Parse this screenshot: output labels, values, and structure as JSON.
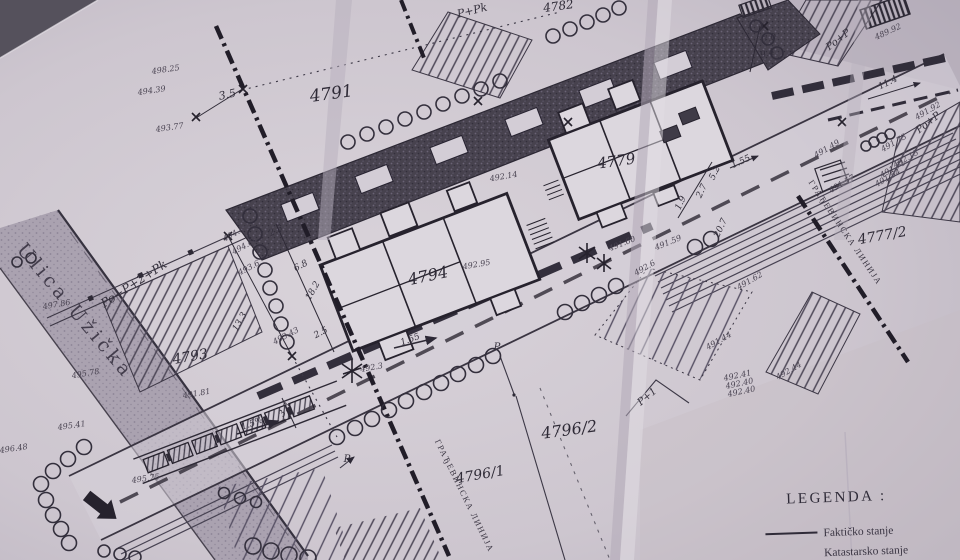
{
  "document": {
    "kind": "scanned cadastral site plan (photographed paper drawing)"
  },
  "street": {
    "name": "Ulica Užička",
    "x": 16,
    "y": 250,
    "r": 50,
    "s": 19
  },
  "labels": {
    "parcels": [
      {
        "t": "4791",
        "x": 332,
        "y": 99,
        "r": -8,
        "s": 17
      },
      {
        "t": "4782",
        "x": 559,
        "y": 10,
        "r": -8,
        "s": 12
      },
      {
        "t": "4779",
        "x": 617,
        "y": 166,
        "r": -8,
        "s": 15
      },
      {
        "t": "4794",
        "x": 429,
        "y": 281,
        "r": -12,
        "s": 16
      },
      {
        "t": "4793",
        "x": 191,
        "y": 361,
        "r": -10,
        "s": 14
      },
      {
        "t": "4796/2",
        "x": 570,
        "y": 435,
        "r": -8,
        "s": 16
      },
      {
        "t": "4796/1",
        "x": 481,
        "y": 479,
        "r": -10,
        "s": 14
      },
      {
        "t": "4777/2",
        "x": 883,
        "y": 240,
        "r": -10,
        "s": 14
      }
    ],
    "buildings": [
      {
        "t": "P+Pk",
        "x": 473,
        "y": 14,
        "r": -14,
        "s": 11
      },
      {
        "t": "Po+P",
        "x": 840,
        "y": 42,
        "r": -38,
        "s": 10
      },
      {
        "t": "Po+P",
        "x": 930,
        "y": 125,
        "r": -38,
        "s": 10
      },
      {
        "t": "Po+P+2+Pk",
        "x": 136,
        "y": 287,
        "r": -33,
        "s": 12
      },
      {
        "t": "P+1",
        "x": 649,
        "y": 399,
        "r": -40,
        "s": 10
      },
      {
        "t": "P",
        "x": 497,
        "y": 350,
        "r": 0,
        "s": 10
      },
      {
        "t": "P",
        "x": 347,
        "y": 462,
        "r": 0,
        "s": 10
      }
    ],
    "lines": [
      {
        "t": "ГРАЂЕВИНСКА ЛИНИЈА",
        "x": 843,
        "y": 234,
        "r": 56,
        "s": 8.5
      },
      {
        "t": "ГРАЂЕВИНСКА ЛИНИЈА",
        "x": 462,
        "y": 497,
        "r": 64,
        "s": 8.5
      }
    ],
    "elevations": [
      {
        "t": "498.25",
        "x": 166,
        "y": 72,
        "r": -8
      },
      {
        "t": "494.39",
        "x": 152,
        "y": 93,
        "r": -8
      },
      {
        "t": "493.77",
        "x": 170,
        "y": 130,
        "r": -8
      },
      {
        "t": "497.86",
        "x": 57,
        "y": 307,
        "r": -10
      },
      {
        "t": "495.78",
        "x": 86,
        "y": 376,
        "r": -10
      },
      {
        "t": "491.81",
        "x": 197,
        "y": 396,
        "r": -10
      },
      {
        "t": "495.41",
        "x": 72,
        "y": 428,
        "r": -8
      },
      {
        "t": "496.48",
        "x": 14,
        "y": 451,
        "r": -8
      },
      {
        "t": "495.75",
        "x": 146,
        "y": 481,
        "r": -8
      },
      {
        "t": "494.65",
        "x": 237,
        "y": 235,
        "r": -28
      },
      {
        "t": "494.64",
        "x": 246,
        "y": 248,
        "r": -28
      },
      {
        "t": "493.6",
        "x": 250,
        "y": 270,
        "r": -28
      },
      {
        "t": "493.43",
        "x": 287,
        "y": 338,
        "r": -28
      },
      {
        "t": "492.95",
        "x": 477,
        "y": 267,
        "r": -10
      },
      {
        "t": "492.14",
        "x": 504,
        "y": 179,
        "r": -10
      },
      {
        "t": "491.60",
        "x": 623,
        "y": 246,
        "r": -22
      },
      {
        "t": "491.59",
        "x": 669,
        "y": 245,
        "r": -22
      },
      {
        "t": "492.6",
        "x": 646,
        "y": 270,
        "r": -30
      },
      {
        "t": "491.44",
        "x": 720,
        "y": 343,
        "r": -30
      },
      {
        "t": "492.44",
        "x": 790,
        "y": 373,
        "r": -30
      },
      {
        "t": "492.41",
        "x": 738,
        "y": 378,
        "r": -12
      },
      {
        "t": "492.40",
        "x": 740,
        "y": 386,
        "r": -12
      },
      {
        "t": "492.40",
        "x": 742,
        "y": 394,
        "r": -12
      },
      {
        "t": "489.92",
        "x": 889,
        "y": 34,
        "r": -25
      },
      {
        "t": "491.92",
        "x": 929,
        "y": 113,
        "r": -30
      },
      {
        "t": "491.49",
        "x": 828,
        "y": 151,
        "r": -30
      },
      {
        "t": "491.73",
        "x": 895,
        "y": 145,
        "r": -30
      },
      {
        "t": "492.15",
        "x": 907,
        "y": 161,
        "r": -30
      },
      {
        "t": "491.71",
        "x": 894,
        "y": 171,
        "r": -30
      },
      {
        "t": "491.54",
        "x": 889,
        "y": 180,
        "r": -30
      },
      {
        "t": "491.57",
        "x": 843,
        "y": 186,
        "r": -30
      },
      {
        "t": "492.3",
        "x": 372,
        "y": 370,
        "r": -10
      },
      {
        "t": "491.62",
        "x": 751,
        "y": 283,
        "r": -30
      }
    ],
    "dimensions": [
      {
        "t": "3.5",
        "x": 228,
        "y": 98,
        "r": -12,
        "s": 11
      },
      {
        "t": "7.0",
        "x": 770,
        "y": 41,
        "r": -15
      },
      {
        "t": "9.4",
        "x": 768,
        "y": 56,
        "r": -15
      },
      {
        "t": "11.4",
        "x": 889,
        "y": 85,
        "r": -27
      },
      {
        "t": "13.3",
        "x": 242,
        "y": 323,
        "r": -60
      },
      {
        "t": "18.2",
        "x": 315,
        "y": 292,
        "r": -60
      },
      {
        "t": "2.5",
        "x": 277,
        "y": 233,
        "r": -28
      },
      {
        "t": "6.8",
        "x": 302,
        "y": 268,
        "r": -28
      },
      {
        "t": "2.5",
        "x": 322,
        "y": 335,
        "r": -28
      },
      {
        "t": "5.2",
        "x": 717,
        "y": 174,
        "r": -65
      },
      {
        "t": "2.7",
        "x": 704,
        "y": 192,
        "r": -65
      },
      {
        "t": "1.9",
        "x": 683,
        "y": 204,
        "r": -65
      },
      {
        "t": "1.55",
        "x": 742,
        "y": 164,
        "r": -25
      },
      {
        "t": "1.55",
        "x": 411,
        "y": 342,
        "r": -20
      },
      {
        "t": "3.8",
        "x": 287,
        "y": 411,
        "r": -60
      },
      {
        "t": "1.5%",
        "x": 253,
        "y": 426,
        "r": -20
      },
      {
        "t": "20.7",
        "x": 723,
        "y": 229,
        "r": -65
      }
    ]
  },
  "legend": {
    "title": "LEGENDA :",
    "items": [
      {
        "symbol": "solid-line",
        "label": "Faktičko stanje"
      },
      {
        "symbol": "dashed-line",
        "label": "Katastarsko stanje"
      }
    ]
  },
  "colors": {
    "paper": "#cdc6cf",
    "ink": "#2e2a36",
    "street_fill": "#aaa2b0",
    "dark_band": "#47424e"
  }
}
